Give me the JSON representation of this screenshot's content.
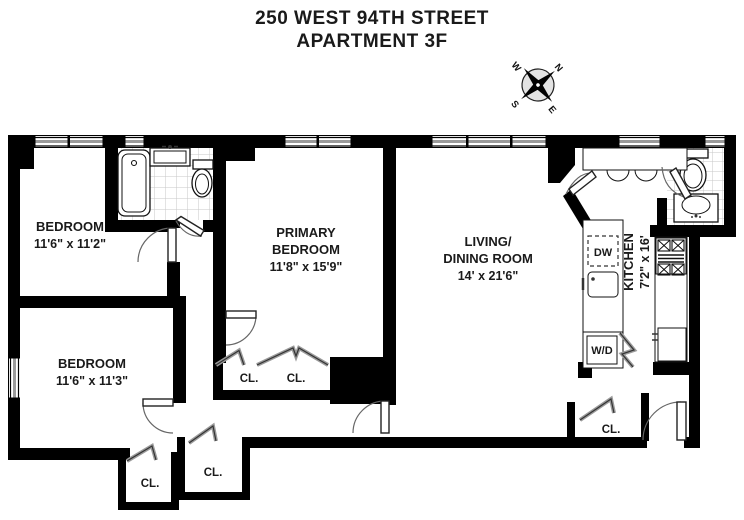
{
  "title": {
    "line1": "250 WEST 94TH STREET",
    "line2": "APARTMENT 3F"
  },
  "compass": {
    "north": "N",
    "south": "S",
    "east": "E",
    "west": "W"
  },
  "rooms": {
    "bedroom_top_left": {
      "name": "BEDROOM",
      "dims": "11'6\" x 11'2\""
    },
    "bedroom_bottom_left": {
      "name": "BEDROOM",
      "dims": "11'6\" x 11'3\""
    },
    "primary_bedroom": {
      "name_line1": "PRIMARY",
      "name_line2": "BEDROOM",
      "dims": "11'8\" x 15'9\""
    },
    "living_dining": {
      "name_line1": "LIVING/",
      "name_line2": "DINING  ROOM",
      "dims": "14' x 21'6\""
    },
    "kitchen": {
      "name": "KITCHEN",
      "dims": "7'2\" x 16'"
    }
  },
  "closets": {
    "primary_left": "CL.",
    "primary_right": "CL.",
    "hall_lower": "CL.",
    "hall_upper": "CL.",
    "entry": "CL."
  },
  "appliances": {
    "dishwasher": "DW",
    "washer_dryer": "W/D"
  },
  "colors": {
    "wall": "#000000",
    "window_mid": "#9a9a9a",
    "tile_line": "#c7c7c7",
    "door_arc": "#666666",
    "closet_door": "#9a9a9a"
  }
}
